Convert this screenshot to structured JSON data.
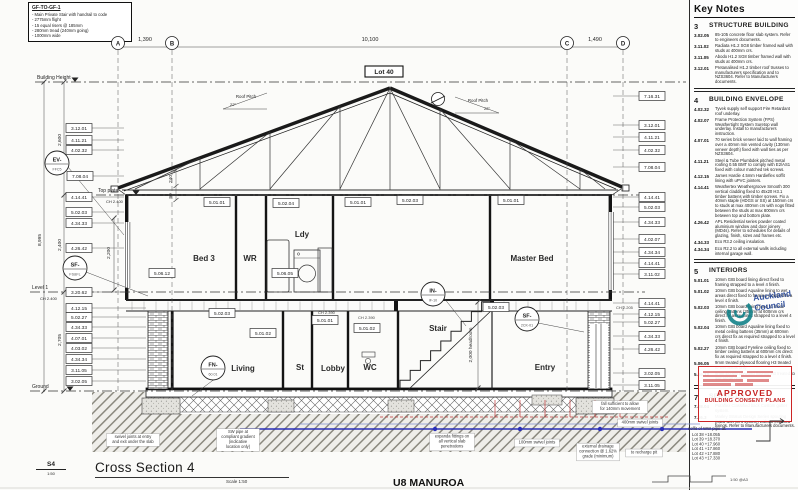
{
  "stair_note": {
    "title": "GF-TO-GF-1",
    "lines": [
      "- Main Private Stair with handrail to code",
      "- 2775mm flight",
      "- 15 equal risers @ 185mm",
      "- 280mm tread (240mm going)",
      "- 1000mm wide"
    ]
  },
  "key_notes": {
    "title": "Key Notes",
    "sections": [
      {
        "num": "3",
        "title": "STRUCTURE BUILDING",
        "items": [
          {
            "code": "3.02.05",
            "text": "85-105 concrete floor slab system. Refer to engineers documents."
          },
          {
            "code": "3.11.02",
            "text": "Radiata H1.2 SG8 timber framed wall with studs at 400mm crs."
          },
          {
            "code": "3.11.05",
            "text": "Abodo H1.2 SG8 timber framed wall with studs at 400mm crs."
          },
          {
            "code": "3.12.01",
            "text": "Pretanalised H1.2 timber roof trusses to manufacturers specification and to NZS3604. Refer to Manufacturers documents."
          }
        ]
      },
      {
        "num": "4",
        "title": "BUILDING ENVELOPE",
        "items": [
          {
            "code": "4.02.32",
            "text": "Tyvek supply self support Fire Retardant roof underlay."
          },
          {
            "code": "4.02.07",
            "text": "Frame Protection System (FPS) Weathertight System Suretop wall underlay. Install to manufacturers instruction."
          },
          {
            "code": "4.07.01",
            "text": "70 series brick veneer laid to wall framing over a 40mm min vented cavity (130mm veneer depth) fixed with wall ties as per NZS3604."
          },
          {
            "code": "4.11.21",
            "text": "Steel & Tube Plumbdek pitched metal roofing 0.55 BMT to comply with E2/AS1 fixed with colour matched tek screws."
          },
          {
            "code": "4.12.15",
            "text": "James Hardie 4.5mm Hardieflex soffit lining with uPVC jointers."
          },
          {
            "code": "4.14.41",
            "text": "Weathertex Weathergroove Smooth 300 vertical cladding fixed to 45x20 H3.1 timber battens with timber screws. Fix a 40mm staple (HDGS or SS) at 150mm crs to studs at max 400mm crs with nogs fitted between the studs at max 800mm crs between top and bottom plate."
          },
          {
            "code": "4.26.42",
            "text": "APL Residential series powder coated aluminium window and door joinery (MD4s). Refer to schedules for details of glazing, finish, sizes and frames etc."
          },
          {
            "code": "4.34.33",
            "text": "Eco R3.2 ceiling insulation."
          },
          {
            "code": "4.34.34",
            "text": "Eco R2.2 to all external walls including internal garage wall."
          }
        ]
      },
      {
        "num": "5",
        "title": "INTERIORS",
        "items": [
          {
            "code": "5.01.01",
            "text": "10mm GIB board lining direct fixed to framing strapped to a level 4 finish."
          },
          {
            "code": "5.01.02",
            "text": "10mm GIB board Aqualine lining to wet areas direct fixed to framing strapped to a level 4 finish."
          },
          {
            "code": "5.02.03",
            "text": "10mm GIB board lining fixed to metal ceiling battens (35mm) at 600mm crs direct fix as required strapped to a level 4 finish."
          },
          {
            "code": "5.02.04",
            "text": "10mm GIB board Aqualine lining fixed to metal ceiling battens (35mm) at 600mm crs direct fix as required strapped to a level 4 finish."
          },
          {
            "code": "5.02.27",
            "text": "10mm GIB board Fyreline ceiling fixed to timber ceiling battens at 600mm crs direct fix as required strapped to a level 4 finish."
          },
          {
            "code": "5.06.05",
            "text": "9mm treated plywood flooring H3 treated to wet areas only."
          },
          {
            "code": "5.06.12",
            "text": "9mm Ecoply plywood flooring H3 treated to wet areas only."
          }
        ]
      },
      {
        "num": "7",
        "title": "SERVICES",
        "items": [
          {
            "code": "7.08.04",
            "text": "Puraflex Classified back Custom gutter system."
          },
          {
            "code": "7.16.3",
            "text": "Marley Stratus Design Series spouting (MD5 with vent system) without exposed fixings. Refer to Manufacturers documents."
          }
        ]
      }
    ]
  },
  "stamp": {
    "approved": "APPROVED",
    "subtitle": "BUILDING CONSENT PLANS"
  },
  "council": {
    "line1": "Auckland",
    "line2": "Council"
  },
  "title_block": {
    "marker": "S4",
    "marker_scale": "1:50",
    "title": "Cross Section 4",
    "scale": "Scale 1:50",
    "print_scale": "1:50 @A3",
    "project": "U8 MANUROA"
  },
  "drawing": {
    "lot_label": "Lot 40",
    "roof_pitch": {
      "label": "Roof Pitch",
      "angle": "22°"
    },
    "pitch_annotations": [
      {
        "x": 243,
        "y": 100,
        "dir": -1
      },
      {
        "x": 475,
        "y": 104,
        "dir": 1
      }
    ],
    "grids": [
      {
        "label": "A",
        "x": 118
      },
      {
        "label": "B",
        "x": 172
      },
      {
        "label": "C",
        "x": 567
      },
      {
        "label": "D",
        "x": 623
      }
    ],
    "top_dims": [
      {
        "label": "1,390",
        "x": 145
      },
      {
        "label": "10,100",
        "x": 370
      },
      {
        "label": "1,490",
        "x": 595
      }
    ],
    "levels": [
      {
        "label": "Building Height",
        "sub": "",
        "y": 82,
        "x1": 35,
        "x2": 686
      },
      {
        "label": "Top plate",
        "sub": "CH 2.400",
        "y": 195,
        "x1": 96,
        "x2": 645
      },
      {
        "label": "Level 1",
        "sub": "CH 2.400",
        "y": 292,
        "x1": 30,
        "x2": 645
      },
      {
        "label": "Ground",
        "sub": "",
        "y": 391,
        "x1": 30,
        "x2": 686
      }
    ],
    "left_dims": [
      {
        "label": "8,995",
        "x": 41,
        "y": 240,
        "rot": -90
      },
      {
        "label": "2,600",
        "x": 61,
        "y": 140,
        "rot": -90
      },
      {
        "label": "2,400",
        "x": 61,
        "y": 245,
        "rot": -90
      },
      {
        "label": "2,705",
        "x": 61,
        "y": 340,
        "rot": -90
      },
      {
        "label": "2,200",
        "x": 110,
        "y": 253,
        "rot": -90
      },
      {
        "label": "240",
        "x": 172,
        "y": 179,
        "rot": -90
      },
      {
        "label": "90",
        "x": 172,
        "y": 196,
        "rot": -90
      },
      {
        "label": "2,000 headroom",
        "x": 472,
        "y": 345,
        "rot": -90
      }
    ],
    "rooms": [
      {
        "label": "Bed 3",
        "x": 204,
        "y": 261
      },
      {
        "label": "WR",
        "x": 250,
        "y": 261
      },
      {
        "label": "Ldy",
        "x": 302,
        "y": 237
      },
      {
        "label": "Master Bed",
        "x": 532,
        "y": 261
      },
      {
        "label": "Living",
        "x": 243,
        "y": 371
      },
      {
        "label": "St",
        "x": 300,
        "y": 370
      },
      {
        "label": "Lobby",
        "x": 333,
        "y": 371
      },
      {
        "label": "WC",
        "x": 370,
        "y": 370
      },
      {
        "label": "Stair",
        "x": 438,
        "y": 331
      },
      {
        "label": "Entry",
        "x": 545,
        "y": 370
      }
    ],
    "small_texts": [
      {
        "label": "CH 2.390",
        "x": 318,
        "y": 314
      },
      {
        "label": "CH 2.390",
        "x": 358,
        "y": 319
      },
      {
        "label": "CH 2.205",
        "x": 616,
        "y": 309
      },
      {
        "label": "1:50 @A3",
        "x": 730,
        "y": 481
      }
    ],
    "circle_tags": [
      {
        "label": "EV-",
        "sub": "FFC5",
        "x": 57,
        "y": 163,
        "lx": 124,
        "ly": 235
      },
      {
        "label": "SF-",
        "sub": "FS&FL",
        "x": 75,
        "y": 268,
        "lx": 148,
        "ly": 296
      },
      {
        "label": "FN-",
        "sub": "60.01",
        "x": 213,
        "y": 368,
        "lx": 192,
        "ly": 396
      },
      {
        "label": "IN-",
        "sub": "IF-10",
        "x": 433,
        "y": 294,
        "lx": 466,
        "ly": 326
      },
      {
        "label": "SF-",
        "sub": "2CK-01",
        "x": 527,
        "y": 319,
        "lx": 584,
        "ly": 332
      }
    ],
    "ref_tags": [
      {
        "label": "3.12.01",
        "x": 79,
        "y": 128,
        "side": "left"
      },
      {
        "label": "4.11.21",
        "x": 79,
        "y": 140,
        "side": "left"
      },
      {
        "label": "4.02.32",
        "x": 79,
        "y": 150,
        "side": "left"
      },
      {
        "label": "7.08.04",
        "x": 80,
        "y": 176,
        "side": "left"
      },
      {
        "label": "4.14.41",
        "x": 79,
        "y": 197,
        "side": "left"
      },
      {
        "label": "5.02.03",
        "x": 79,
        "y": 212,
        "side": "left"
      },
      {
        "label": "4.34.33",
        "x": 79,
        "y": 223,
        "side": "left"
      },
      {
        "label": "4.26.42",
        "x": 79,
        "y": 248,
        "side": "left"
      },
      {
        "label": "3.20.62",
        "x": 79,
        "y": 292,
        "side": "left"
      },
      {
        "label": "4.12.15",
        "x": 79,
        "y": 308,
        "side": "left"
      },
      {
        "label": "5.02.27",
        "x": 79,
        "y": 317,
        "side": "left"
      },
      {
        "label": "4.34.33",
        "x": 79,
        "y": 327,
        "side": "left"
      },
      {
        "label": "4.07.01",
        "x": 79,
        "y": 338,
        "side": "left"
      },
      {
        "label": "4.03.02",
        "x": 79,
        "y": 348,
        "side": "left"
      },
      {
        "label": "4.34.34",
        "x": 79,
        "y": 359,
        "side": "left"
      },
      {
        "label": "3.11.05",
        "x": 79,
        "y": 370,
        "side": "left"
      },
      {
        "label": "3.02.05",
        "x": 79,
        "y": 381,
        "side": "left"
      },
      {
        "label": "7.16.31",
        "x": 652,
        "y": 96,
        "side": "right"
      },
      {
        "label": "3.12.01",
        "x": 652,
        "y": 125,
        "side": "right"
      },
      {
        "label": "4.11.21",
        "x": 652,
        "y": 137,
        "side": "right"
      },
      {
        "label": "4.02.32",
        "x": 652,
        "y": 150,
        "side": "right"
      },
      {
        "label": "7.08.04",
        "x": 652,
        "y": 167,
        "side": "right"
      },
      {
        "label": "4.14.41",
        "x": 652,
        "y": 197,
        "side": "right"
      },
      {
        "label": "5.02.03",
        "x": 652,
        "y": 207,
        "side": "right"
      },
      {
        "label": "4.34.33",
        "x": 652,
        "y": 222,
        "side": "right"
      },
      {
        "label": "4.02.07",
        "x": 652,
        "y": 239,
        "side": "right"
      },
      {
        "label": "4.34.34",
        "x": 652,
        "y": 252,
        "side": "right"
      },
      {
        "label": "4.14.41",
        "x": 652,
        "y": 263,
        "side": "right"
      },
      {
        "label": "3.11.02",
        "x": 652,
        "y": 274,
        "side": "right"
      },
      {
        "label": "4.14.41",
        "x": 652,
        "y": 303,
        "side": "right"
      },
      {
        "label": "4.12.15",
        "x": 652,
        "y": 314,
        "side": "right"
      },
      {
        "label": "5.02.27",
        "x": 652,
        "y": 322,
        "side": "right"
      },
      {
        "label": "4.34.33",
        "x": 652,
        "y": 336,
        "side": "right"
      },
      {
        "label": "4.26.42",
        "x": 652,
        "y": 349,
        "side": "right"
      },
      {
        "label": "3.02.05",
        "x": 652,
        "y": 373,
        "side": "right"
      },
      {
        "label": "3.11.05",
        "x": 652,
        "y": 385,
        "side": "right"
      },
      {
        "label": "5.01.01",
        "x": 217,
        "y": 202,
        "side": "float"
      },
      {
        "label": "5.02.04",
        "x": 286,
        "y": 203,
        "side": "float"
      },
      {
        "label": "5.01.01",
        "x": 358,
        "y": 202,
        "side": "float"
      },
      {
        "label": "5.02.03",
        "x": 410,
        "y": 200,
        "side": "float"
      },
      {
        "label": "5.01.01",
        "x": 511,
        "y": 200,
        "side": "float"
      },
      {
        "label": "5.06.12",
        "x": 162,
        "y": 273,
        "side": "float"
      },
      {
        "label": "5.06.05",
        "x": 285,
        "y": 273,
        "side": "float"
      },
      {
        "label": "5.02.03",
        "x": 222,
        "y": 313,
        "side": "float"
      },
      {
        "label": "5.01.02",
        "x": 263,
        "y": 333,
        "side": "float"
      },
      {
        "label": "5.01.01",
        "x": 325,
        "y": 320,
        "side": "float"
      },
      {
        "label": "5.01.02",
        "x": 367,
        "y": 328,
        "side": "float"
      },
      {
        "label": "5.02.03",
        "x": 496,
        "y": 307,
        "side": "float"
      }
    ],
    "notes": [
      {
        "x": 133,
        "y": 440,
        "lines": [
          "swivel joints at entry",
          "and exit under the slab"
        ]
      },
      {
        "x": 238,
        "y": 440,
        "lines": [
          "SW pipe at",
          "compliant gradient",
          "(indicative",
          "location only)"
        ]
      },
      {
        "x": 452,
        "y": 442,
        "lines": [
          "expanda fittings on",
          "all vertical slab",
          "penetrations"
        ]
      },
      {
        "x": 537,
        "y": 443,
        "lines": [
          "100mm swivel joints"
        ]
      },
      {
        "x": 598,
        "y": 452,
        "lines": [
          "external drainage",
          "connection @ 1.62%",
          "grade (minimum)"
        ]
      },
      {
        "x": 620,
        "y": 407,
        "lines": [
          "fall sufficient to allow",
          "for 140mm movement"
        ]
      },
      {
        "x": 640,
        "y": 423,
        "lines": [
          "400mm swivel joints"
        ]
      },
      {
        "x": 644,
        "y": 453,
        "lines": [
          "to recharge pit"
        ]
      }
    ],
    "lot_list": {
      "title": "soffit of WW pipe at:",
      "items": [
        "Lot 38  +18.055",
        "Lot 39  +18.370",
        "Lot 40  +17.960",
        "Lot 41  +17.860",
        "Lot 42  +17.880",
        "Lot 43  +17.330"
      ]
    }
  }
}
